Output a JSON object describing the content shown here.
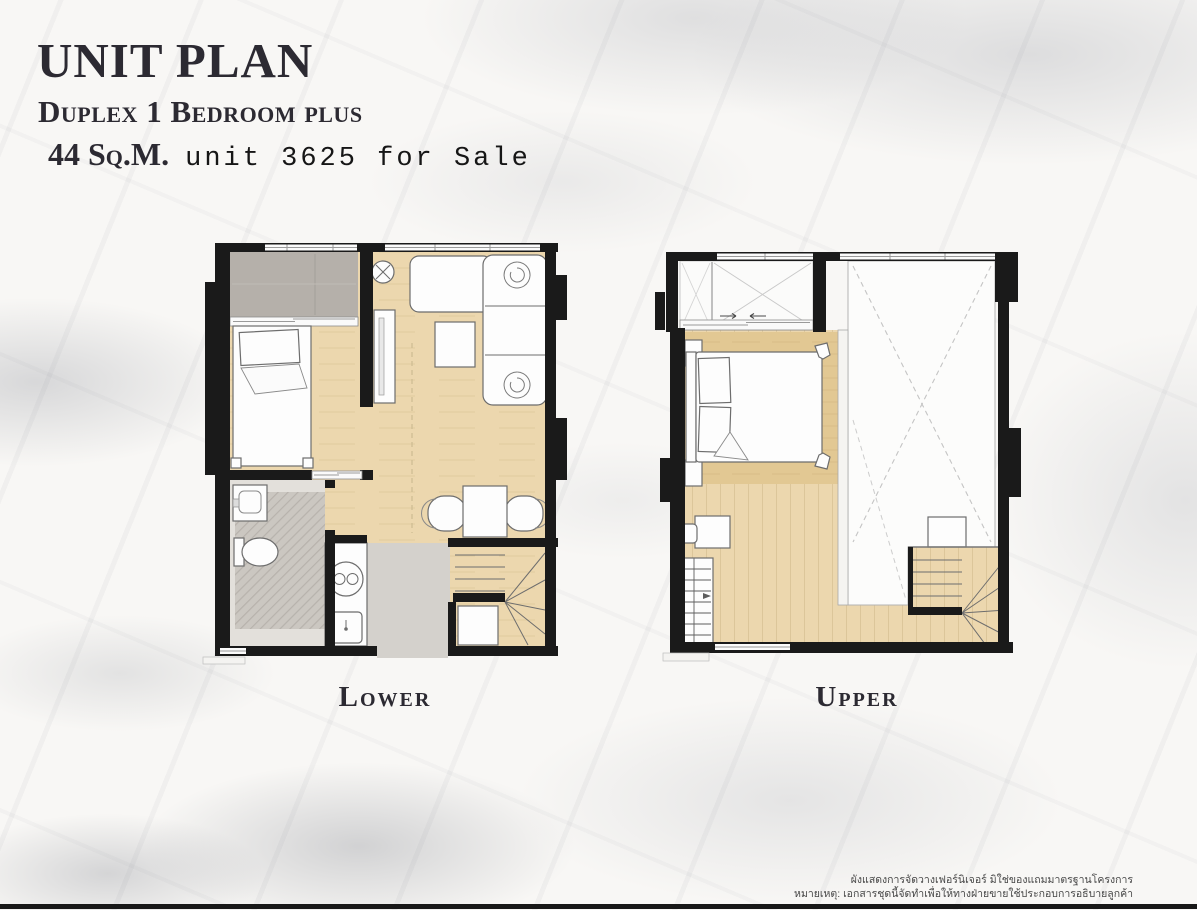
{
  "header": {
    "title": "UNIT PLAN",
    "subtitle": "Duplex 1 Bedroom plus",
    "area": "44 Sq.M.",
    "sale_text": "unit 3625 for Sale"
  },
  "plans": {
    "lower_label": "Lower",
    "upper_label": "Upper"
  },
  "footer": {
    "disclaimer_line1": "ผังแสดงการจัดวางเฟอร์นิเจอร์ มิใช่ของแถมมาตรฐานโครงการ",
    "disclaimer_line2": "หมายเหตุ: เอกสารชุดนี้จัดทำเพื่อให้ทางฝ่ายขายใช้ประกอบการอธิบายลูกค้า"
  },
  "colors": {
    "wall": "#1a1a1a",
    "wood": "#ecd7ae",
    "wood_dark": "#e2c893",
    "plank": "#dcc69a",
    "balcony": "#b5b0aa",
    "tile": "#d4d1cc",
    "tile_dark": "#bdb8b2",
    "bath": "#e3e0db",
    "furn": "#fdfdfd",
    "outline": "#6d6d6d",
    "ink": "#2c2a32",
    "thai": "#474747"
  }
}
